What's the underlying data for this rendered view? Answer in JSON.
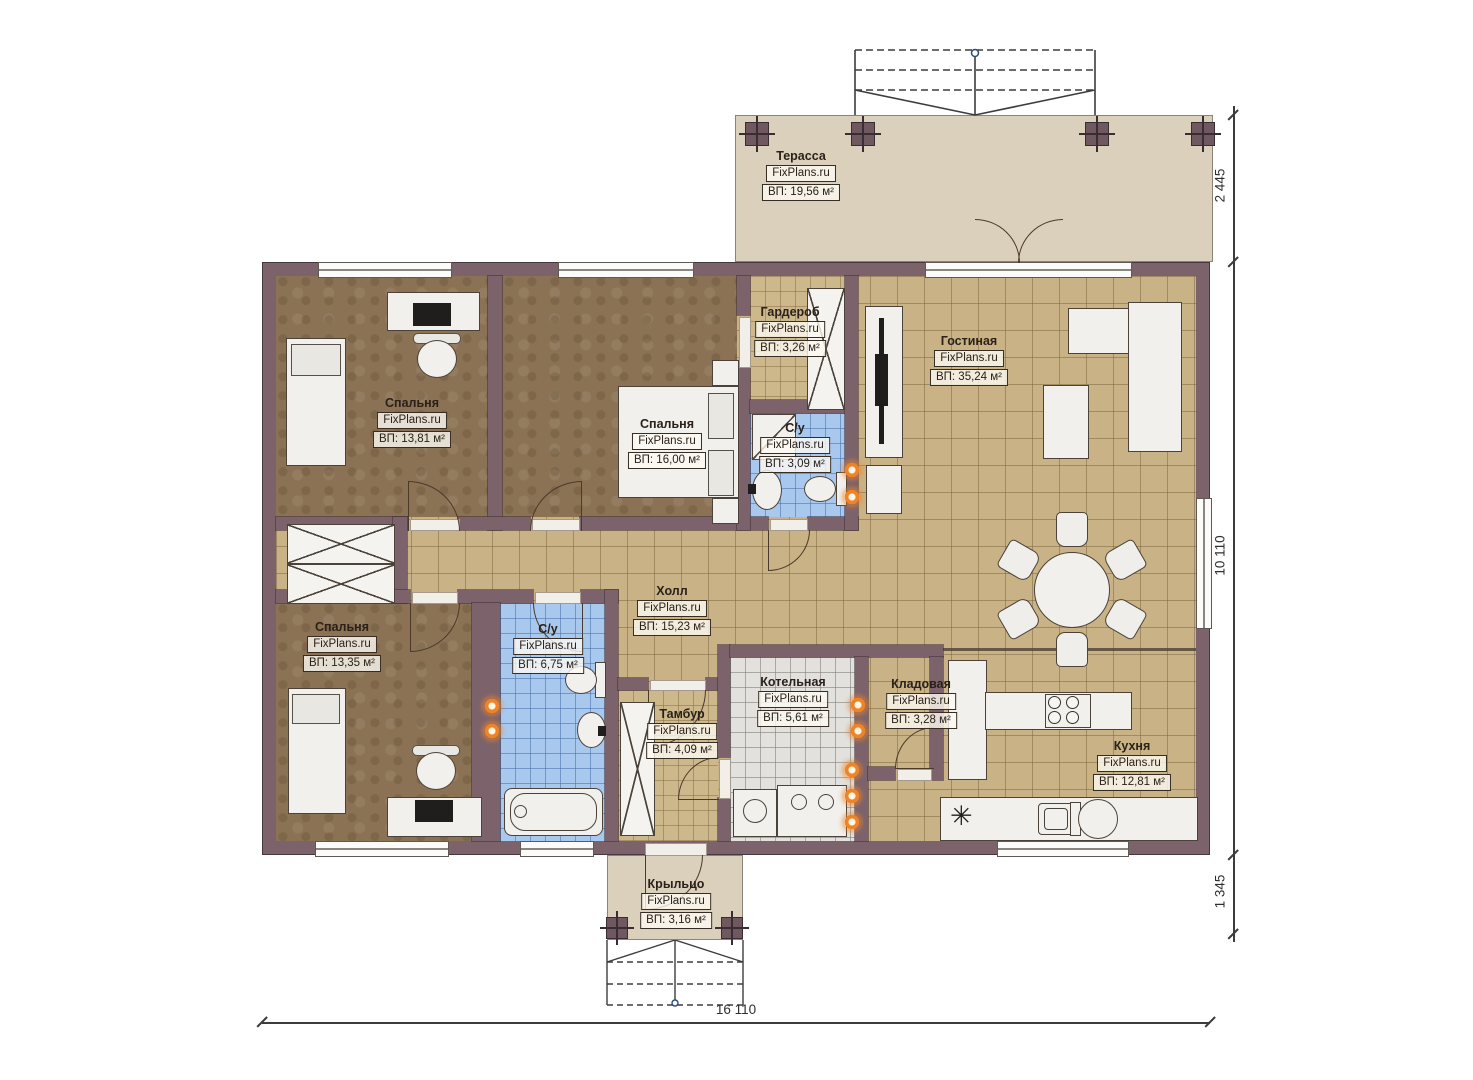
{
  "watermark": "FixPlans.ru",
  "rooms": {
    "terrace": {
      "name": "Терасса",
      "area": "ВП: 19,56 м²"
    },
    "bedroom1": {
      "name": "Спальня",
      "area": "ВП: 13,81 м²"
    },
    "bedroom2": {
      "name": "Спальня",
      "area": "ВП: 16,00 м²"
    },
    "wardrobe": {
      "name": "Гардероб",
      "area": "ВП: 3,26 м²"
    },
    "bath1": {
      "name": "С/у",
      "area": "ВП: 3,09 м²"
    },
    "living": {
      "name": "Гостиная",
      "area": "ВП: 35,24 м²"
    },
    "hall": {
      "name": "Холл",
      "area": "ВП: 15,23 м²"
    },
    "bedroom3": {
      "name": "Спальня",
      "area": "ВП: 13,35 м²"
    },
    "bath2": {
      "name": "С/у",
      "area": "ВП: 6,75 м²"
    },
    "tambur": {
      "name": "Тамбур",
      "area": "ВП: 4,09 м²"
    },
    "boiler": {
      "name": "Котельная",
      "area": "ВП: 5,61 м²"
    },
    "storage": {
      "name": "Кладовая",
      "area": "ВП: 3,28 м²"
    },
    "kitchen": {
      "name": "Кухня",
      "area": "ВП: 12,81 м²"
    },
    "porch": {
      "name": "Крыльцо",
      "area": "ВП: 3,16 м²"
    }
  },
  "dimensions": {
    "terrace_depth": "2 445",
    "house_depth": "10 110",
    "porch_depth": "1 345",
    "house_width": "16 110"
  },
  "symbols": {
    "fridge": "✳"
  }
}
